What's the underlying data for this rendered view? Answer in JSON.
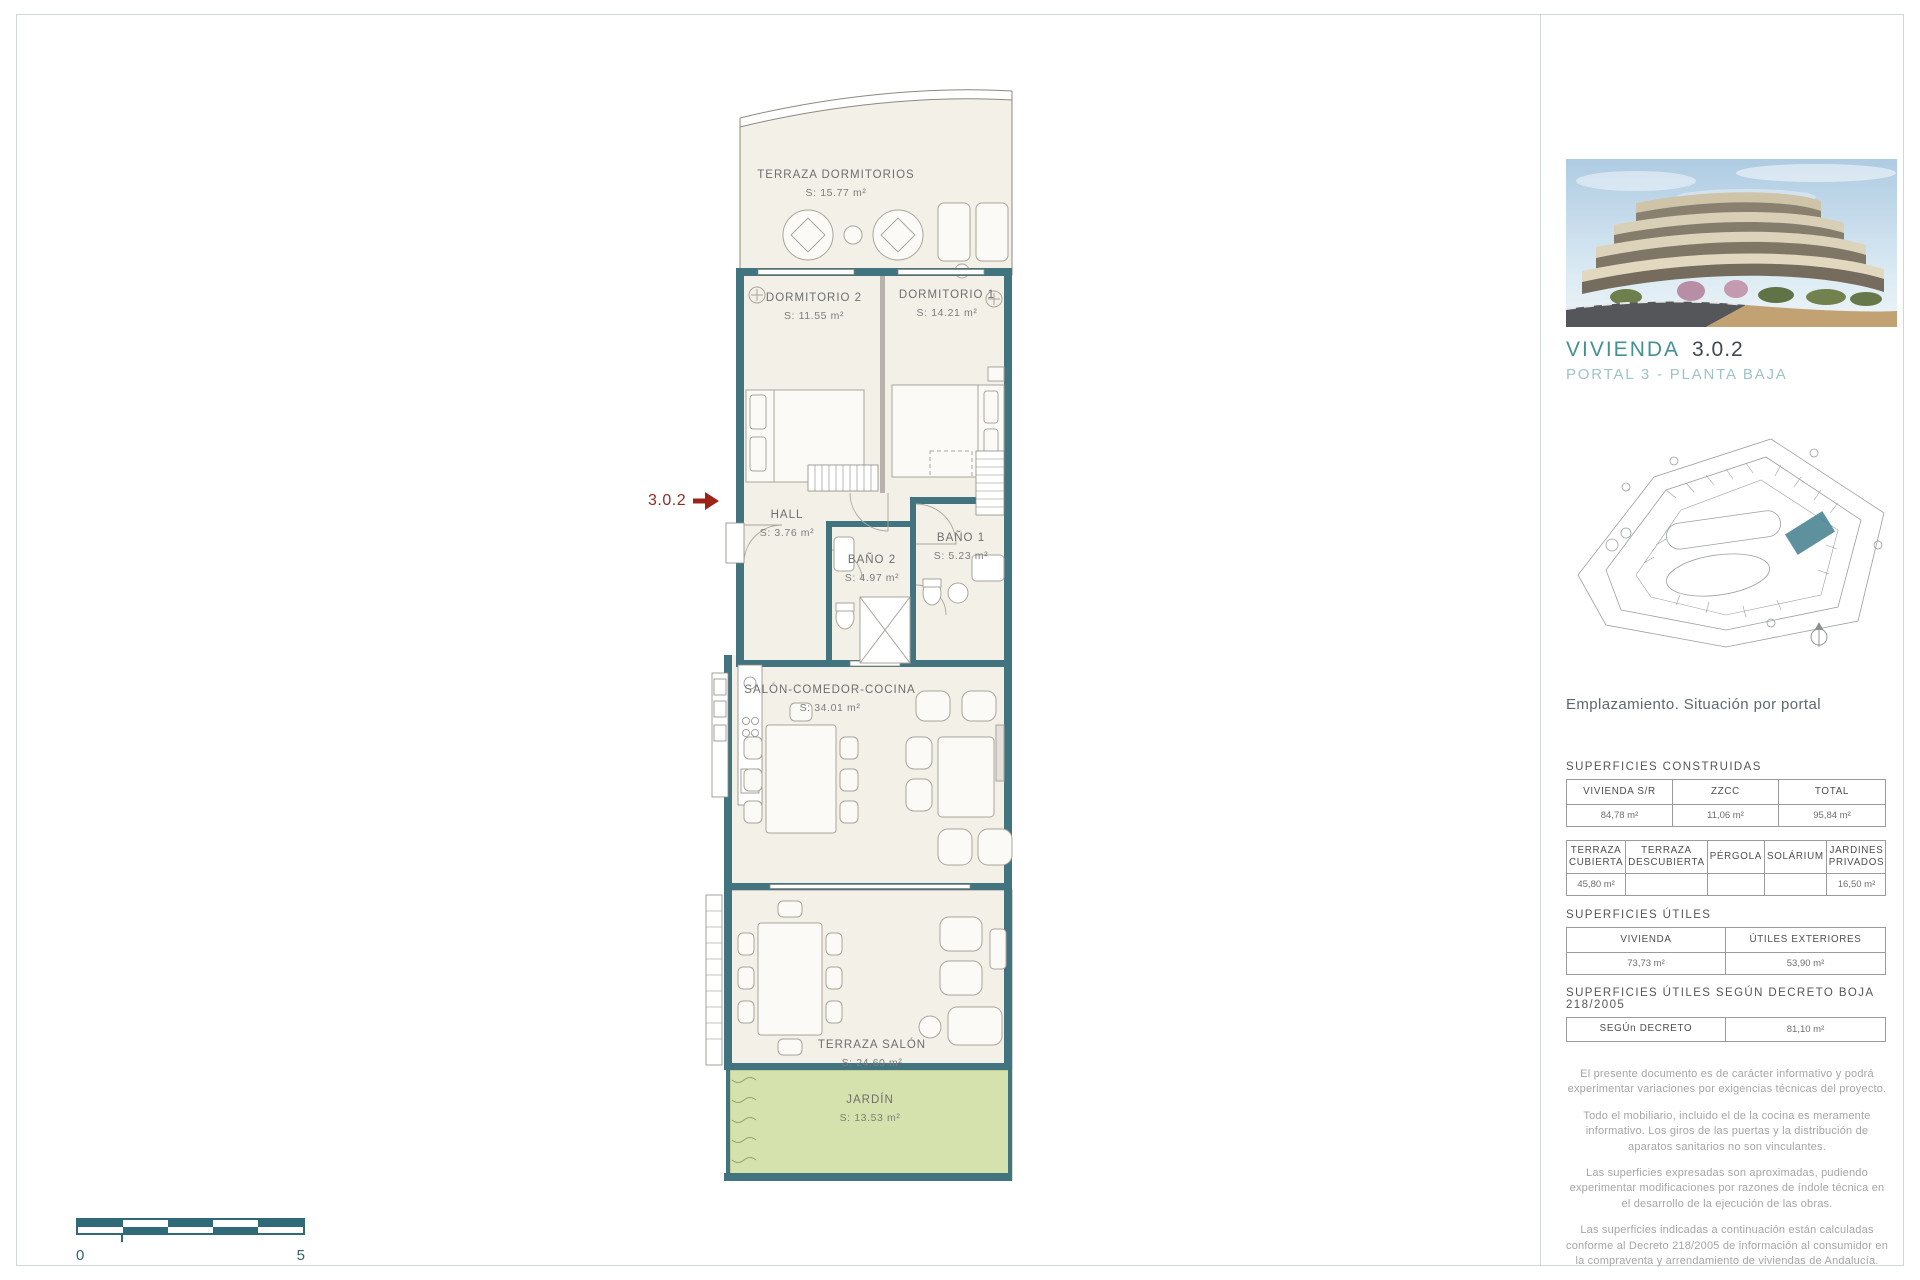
{
  "plan": {
    "pointer": {
      "label": "3.0.2"
    },
    "rooms": [
      {
        "name": "TERRAZA DORMITORIOS",
        "area": "S: 15.77 m²"
      },
      {
        "name": "DORMITORIO 2",
        "area": "S: 11.55 m²"
      },
      {
        "name": "DORMITORIO 1",
        "area": "S: 14.21 m²"
      },
      {
        "name": "HALL",
        "area": "S: 3.76 m²"
      },
      {
        "name": "BAÑO 2",
        "area": "S: 4.97 m²"
      },
      {
        "name": "BAÑO 1",
        "area": "S: 5.23 m²"
      },
      {
        "name": "SALÓN-COMEDOR-COCINA",
        "area": "S: 34.01 m²"
      },
      {
        "name": "TERRAZA SALÓN",
        "area": "S: 24.60 m²"
      },
      {
        "name": "JARDÍN",
        "area": "S: 13.53 m²"
      }
    ],
    "scalebar": {
      "start": "0",
      "end": "5"
    }
  },
  "sidebar": {
    "unit": {
      "title": "VIVIENDA",
      "number": "3.0.2",
      "subtitle": "PORTAL 3 - PLANTA BAJA"
    },
    "siteplan_caption": "Emplazamiento. Situación por portal",
    "construidas": {
      "heading": "SUPERFICIES CONSTRUIDAS",
      "table1": {
        "headers": [
          "VIVIENDA S/R",
          "ZZCC",
          "TOTAL"
        ],
        "values": [
          "84,78 m²",
          "11,06 m²",
          "95,84 m²"
        ]
      },
      "table2": {
        "headers": [
          "TERRAZA CUBIERTA",
          "TERRAZA DESCUBIERTA",
          "PÉRGOLA",
          "SOLÁRIUM",
          "JARDINES PRIVADOS"
        ],
        "values": [
          "45,80 m²",
          "",
          "",
          "",
          "16,50 m²"
        ]
      }
    },
    "utiles": {
      "heading": "SUPERFICIES ÚTILES",
      "table": {
        "headers": [
          "VIVIENDA",
          "ÚTILES EXTERIORES"
        ],
        "values": [
          "73,73 m²",
          "53,90 m²"
        ]
      }
    },
    "decreto": {
      "heading": "SUPERFICIES ÚTILES SEGÚN DECRETO BOJA 218/2005",
      "label": "SEGÚn DECRETO",
      "value": "81,10 m²"
    },
    "notes": [
      "El presente documento es de carácter informativo y podrá experimentar variaciones por exigencias técnicas del proyecto.",
      "Todo el mobiliario, incluido el de la cocina es meramente informativo. Los giros de las puertas y la distribución de aparatos sanitarios no son vinculantes.",
      "Las superficies expresadas son aproximadas, pudiendo experimentar modificaciones por razones de índole técnica en el desarrollo de la ejecución de las obras.",
      "Las superficies indicadas a continuación están calculadas conforme al Decreto 218/2005 de información al consumidor en la compraventa y arrendamiento de viviendas de Andalucía."
    ]
  },
  "colors": {
    "wall_teal": "#41747f",
    "accent_red": "#9e2317",
    "brand_teal": "#459093",
    "garden_green": "#d5e2ae"
  }
}
